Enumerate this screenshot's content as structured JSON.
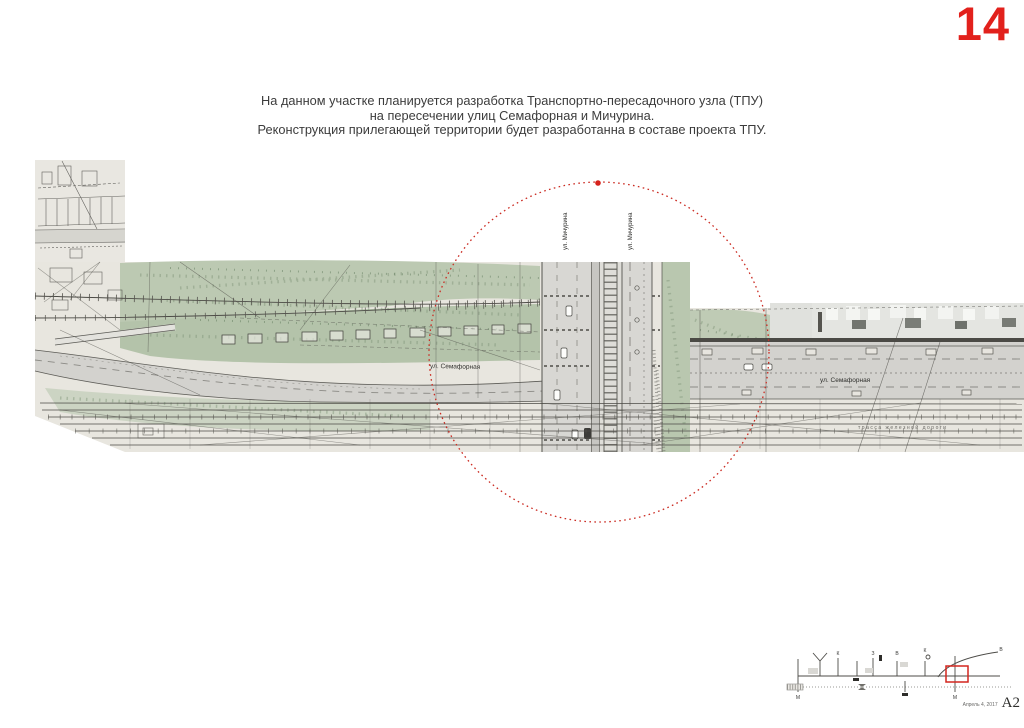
{
  "page": {
    "number": "14",
    "accent_color": "#e2211c"
  },
  "annotation": {
    "line1": "На данном участке планируется разработка Транспортно-пересадочного узла (ТПУ)",
    "line2": "на пересечении улиц Семафорная и Мичурина.",
    "line3": "Реконструкция прилегающей территории будет разработанна в составе проекта ТПУ."
  },
  "map": {
    "labels": {
      "michurina_left": "ул. Мичурина",
      "michurina_right": "ул. Мичурина",
      "semafornaya_left": "ул. Семафорная",
      "semafornaya_right": "ул. Семафорная",
      "railway_note": "трасса железной дороги"
    },
    "colors": {
      "highlight": "#cb2b22",
      "vegetation": "#bcc9b2",
      "road": "#d4d3cf",
      "ink": "#42413d"
    }
  },
  "footer": {
    "date": "Апрель 4, 2017",
    "sheet": "А2",
    "scheme": {
      "labels": [
        "К",
        "З",
        "В",
        "К",
        "В"
      ],
      "metro_labels": [
        "М",
        "М"
      ]
    }
  }
}
